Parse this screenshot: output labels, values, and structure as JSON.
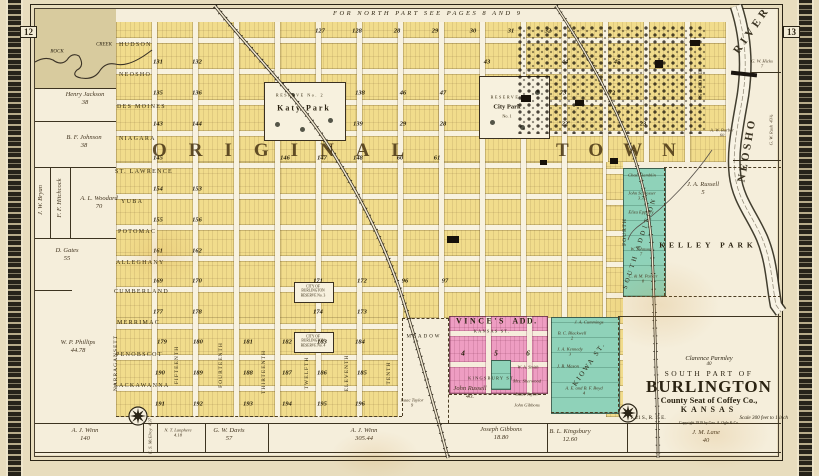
{
  "page": {
    "left_num": "12",
    "right_num": "13",
    "top_note": "FOR NORTH PART SEE PAGES 8 AND 9"
  },
  "title_block": {
    "owner": "Clarence Parmley",
    "owner_acres": "40",
    "part": "SOUTH PART OF",
    "city": "BURLINGTON",
    "seat": "County Seat of Coffey Co.,",
    "state": "KANSAS",
    "township": "T. 21 S., R. 15 E.",
    "scale": "Scale 300 feet to 1 inch",
    "copyright": "Copyright 1919 by Geo. A. Ogle & Co."
  },
  "big_labels": {
    "original": "ORIGINAL",
    "town": "TOWN"
  },
  "river": {
    "top": "RIVER",
    "side": "NEOSHO"
  },
  "creek": {
    "w1": "ROCK",
    "w2": "CREEK"
  },
  "parks": {
    "katy": {
      "reserve": "RESERVE",
      "no": "No. 2",
      "name": "Katy Park"
    },
    "city": {
      "reserve": "RESERVE",
      "name": "City Park",
      "no": "No. 1"
    },
    "kelley": "KELLEY PARK"
  },
  "reserves": [
    {
      "l1": "CITY OF",
      "l2": "BURLINGTON",
      "l3": "RESERVE No. 3",
      "x": 294,
      "y": 282
    },
    {
      "l1": "CITY OF",
      "l2": "BURLINGTON",
      "l3": "RESERVE No. 4",
      "x": 294,
      "y": 332
    }
  ],
  "additions": {
    "vince1": "VINCE'S",
    "vince2": "ADD.",
    "kansas": "KANSAS ST.",
    "kingsbury": "KINGSBURY ST.",
    "vince_blocks": [
      {
        "n": "4",
        "x": 463,
        "y": 353
      },
      {
        "n": "5",
        "x": 496,
        "y": 353
      },
      {
        "n": "6",
        "x": 528,
        "y": 353
      }
    ],
    "south": "SOUTH ADDITION",
    "kiowa": "KIOWA ST.",
    "meadow": "MEADOW"
  },
  "streets_ew": [
    {
      "name": "HUDSON",
      "x": 119,
      "y": 45
    },
    {
      "name": "NEOSHO",
      "x": 119,
      "y": 75
    },
    {
      "name": "DES MOINES",
      "x": 117,
      "y": 107
    },
    {
      "name": "NIAGARA",
      "x": 119,
      "y": 139
    },
    {
      "name": "ST. LAWRENCE",
      "x": 115,
      "y": 172
    },
    {
      "name": "YUBA",
      "x": 121,
      "y": 202
    },
    {
      "name": "POTOMAC",
      "x": 118,
      "y": 232
    },
    {
      "name": "ALLEGHANY",
      "x": 116,
      "y": 263
    },
    {
      "name": "CUMBERLAND",
      "x": 114,
      "y": 292
    },
    {
      "name": "MERRIMAC",
      "x": 117,
      "y": 323
    },
    {
      "name": "PENOBSCOT",
      "x": 116,
      "y": 355
    },
    {
      "name": "LACKAWANNA",
      "x": 114,
      "y": 386
    }
  ],
  "streets_ns": [
    {
      "name": "NARRAGANSETT",
      "x": 116,
      "y": 363
    },
    {
      "name": "FIFTEENTH",
      "x": 177,
      "y": 365
    },
    {
      "name": "FOURTEENTH",
      "x": 221,
      "y": 365
    },
    {
      "name": "THIRTEENTH",
      "x": 264,
      "y": 372
    },
    {
      "name": "TWELFTH",
      "x": 307,
      "y": 373
    },
    {
      "name": "ELEVENTH",
      "x": 347,
      "y": 373
    },
    {
      "name": "TENTH",
      "x": 389,
      "y": 373
    },
    {
      "name": "FOURTH",
      "x": 625,
      "y": 232
    },
    {
      "name": "SECOND",
      "x": 701,
      "y": 83
    }
  ],
  "parcels": [
    {
      "name": "Henry Jackson",
      "acres": "38",
      "x": 85,
      "y": 99
    },
    {
      "name": "B. F. Johnson",
      "acres": "38",
      "x": 84,
      "y": 142
    },
    {
      "name": "J. W. Bryan",
      "acres": "",
      "x": 41,
      "y": 200,
      "rot": -90
    },
    {
      "name": "F. F. Hitchcock",
      "acres": "",
      "x": 60,
      "y": 198,
      "rot": -90
    },
    {
      "name": "A. L. Woodard",
      "acres": "70",
      "x": 99,
      "y": 203
    },
    {
      "name": "D. Gates",
      "acres": "55",
      "x": 67,
      "y": 255
    },
    {
      "name": "W. P. Phillips",
      "acres": "44.78",
      "x": 78,
      "y": 347
    },
    {
      "name": "A. J. Winn",
      "acres": "140",
      "x": 85,
      "y": 435
    },
    {
      "name": "E. S. McElroy",
      "acres": "4.37",
      "x": 150,
      "y": 436,
      "rot": -90,
      "sm": 1
    },
    {
      "name": "N. T. Lanphere",
      "acres": "4.18",
      "x": 178,
      "y": 433,
      "sm": 1
    },
    {
      "name": "G. W. Davis",
      "acres": "57",
      "x": 229,
      "y": 435
    },
    {
      "name": "A. J. Winn",
      "acres": "305.44",
      "x": 364,
      "y": 435
    },
    {
      "name": "Isaac Taylor",
      "acres": "9",
      "x": 412,
      "y": 403,
      "sm": 1
    },
    {
      "name": "John Russell",
      "acres": "40.",
      "x": 470,
      "y": 393
    },
    {
      "name": "W. A. Smith",
      "acres": "",
      "x": 528,
      "y": 367,
      "sm": 1
    },
    {
      "name": "Mrs. Sherwood",
      "acres": "",
      "x": 527,
      "y": 381,
      "sm": 1
    },
    {
      "name": "Isaac Taylor",
      "acres": "",
      "x": 527,
      "y": 394,
      "sm": 1
    },
    {
      "name": "John Gibbons",
      "acres": "",
      "x": 527,
      "y": 405,
      "sm": 1
    },
    {
      "name": "Joseph Gibbons",
      "acres": "18.80",
      "x": 501,
      "y": 434
    },
    {
      "name": "B. L. Kingsbury",
      "acres": "12.60",
      "x": 570,
      "y": 436
    },
    {
      "name": "J. M. Lane",
      "acres": "40",
      "x": 706,
      "y": 437
    },
    {
      "name": "J. A. Cummings",
      "acres": "",
      "x": 589,
      "y": 322,
      "sm": 1
    },
    {
      "name": "B. C. Blackwell",
      "acres": "2",
      "x": 572,
      "y": 336,
      "sm": 1
    },
    {
      "name": "J. A. Kennedy",
      "acres": "3",
      "x": 570,
      "y": 352,
      "sm": 1
    },
    {
      "name": "J. B. Mason",
      "acres": "",
      "x": 568,
      "y": 366,
      "sm": 1
    },
    {
      "name": "A. E. and B. F. Boyd",
      "acres": "4",
      "x": 584,
      "y": 391,
      "sm": 1
    },
    {
      "name": "J. A. Russell",
      "acres": "5",
      "x": 703,
      "y": 189
    },
    {
      "name": "G. W. Hicks",
      "acres": "7",
      "x": 762,
      "y": 64,
      "sm": 1
    },
    {
      "name": "G. W. Rush",
      "acres": "43¾",
      "x": 771,
      "y": 130,
      "rot": -90,
      "sm": 1
    },
    {
      "name": "A. W. Barber",
      "acres": "60",
      "x": 722,
      "y": 133,
      "sm": 1
    },
    {
      "name": "Chas. Hamblin",
      "acres": "1",
      "x": 642,
      "y": 178,
      "sm": 1
    },
    {
      "name": "John Schlosser",
      "acres": "3.32",
      "x": 642,
      "y": 196,
      "sm": 1
    },
    {
      "name": "Eliza Epperly",
      "acres": "",
      "x": 641,
      "y": 212,
      "sm": 1
    },
    {
      "name": "W. Johnson",
      "acres": "7",
      "x": 641,
      "y": 252,
      "sm": 1
    },
    {
      "name": "C. & M. Parker",
      "acres": "8",
      "x": 643,
      "y": 279,
      "sm": 1
    }
  ],
  "block_numbers": [
    {
      "n": "127",
      "x": 320,
      "y": 31
    },
    {
      "n": "128",
      "x": 357,
      "y": 31
    },
    {
      "n": "28",
      "x": 397,
      "y": 31
    },
    {
      "n": "29",
      "x": 435,
      "y": 31
    },
    {
      "n": "30",
      "x": 473,
      "y": 31
    },
    {
      "n": "31",
      "x": 511,
      "y": 31
    },
    {
      "n": "32",
      "x": 548,
      "y": 31
    },
    {
      "n": "131",
      "x": 158,
      "y": 62
    },
    {
      "n": "132",
      "x": 197,
      "y": 62
    },
    {
      "n": "43",
      "x": 487,
      "y": 62
    },
    {
      "n": "44",
      "x": 565,
      "y": 62
    },
    {
      "n": "45",
      "x": 617,
      "y": 62
    },
    {
      "n": "135",
      "x": 158,
      "y": 93
    },
    {
      "n": "136",
      "x": 197,
      "y": 93
    },
    {
      "n": "138",
      "x": 360,
      "y": 93
    },
    {
      "n": "46",
      "x": 403,
      "y": 93
    },
    {
      "n": "47",
      "x": 443,
      "y": 93
    },
    {
      "n": "73",
      "x": 563,
      "y": 93
    },
    {
      "n": "72",
      "x": 612,
      "y": 93
    },
    {
      "n": "143",
      "x": 158,
      "y": 124
    },
    {
      "n": "144",
      "x": 197,
      "y": 124
    },
    {
      "n": "139",
      "x": 358,
      "y": 124
    },
    {
      "n": "29",
      "x": 403,
      "y": 124
    },
    {
      "n": "28",
      "x": 443,
      "y": 124
    },
    {
      "n": "22",
      "x": 565,
      "y": 124
    },
    {
      "n": "23",
      "x": 643,
      "y": 124
    },
    {
      "n": "145",
      "x": 158,
      "y": 158
    },
    {
      "n": "146",
      "x": 285,
      "y": 158
    },
    {
      "n": "147",
      "x": 322,
      "y": 158
    },
    {
      "n": "148",
      "x": 358,
      "y": 158
    },
    {
      "n": "60",
      "x": 400,
      "y": 158
    },
    {
      "n": "61",
      "x": 437,
      "y": 158
    },
    {
      "n": "154",
      "x": 158,
      "y": 189
    },
    {
      "n": "153",
      "x": 197,
      "y": 189
    },
    {
      "n": "155",
      "x": 158,
      "y": 220
    },
    {
      "n": "156",
      "x": 197,
      "y": 220
    },
    {
      "n": "161",
      "x": 158,
      "y": 251
    },
    {
      "n": "162",
      "x": 197,
      "y": 251
    },
    {
      "n": "169",
      "x": 158,
      "y": 281
    },
    {
      "n": "170",
      "x": 197,
      "y": 281
    },
    {
      "n": "171",
      "x": 318,
      "y": 281
    },
    {
      "n": "172",
      "x": 362,
      "y": 281
    },
    {
      "n": "96",
      "x": 405,
      "y": 281
    },
    {
      "n": "97",
      "x": 445,
      "y": 281
    },
    {
      "n": "177",
      "x": 158,
      "y": 312
    },
    {
      "n": "178",
      "x": 197,
      "y": 312
    },
    {
      "n": "174",
      "x": 318,
      "y": 312
    },
    {
      "n": "173",
      "x": 362,
      "y": 312
    },
    {
      "n": "179",
      "x": 162,
      "y": 342
    },
    {
      "n": "180",
      "x": 198,
      "y": 342
    },
    {
      "n": "181",
      "x": 248,
      "y": 342
    },
    {
      "n": "182",
      "x": 287,
      "y": 342
    },
    {
      "n": "183",
      "x": 322,
      "y": 342
    },
    {
      "n": "184",
      "x": 360,
      "y": 342
    },
    {
      "n": "190",
      "x": 160,
      "y": 373
    },
    {
      "n": "189",
      "x": 198,
      "y": 373
    },
    {
      "n": "188",
      "x": 248,
      "y": 373
    },
    {
      "n": "187",
      "x": 287,
      "y": 373
    },
    {
      "n": "186",
      "x": 322,
      "y": 373
    },
    {
      "n": "185",
      "x": 362,
      "y": 373
    },
    {
      "n": "191",
      "x": 160,
      "y": 404
    },
    {
      "n": "192",
      "x": 198,
      "y": 404
    },
    {
      "n": "193",
      "x": 248,
      "y": 404
    },
    {
      "n": "194",
      "x": 287,
      "y": 404
    },
    {
      "n": "195",
      "x": 322,
      "y": 404
    },
    {
      "n": "196",
      "x": 360,
      "y": 404
    }
  ],
  "lines": [
    {
      "x": 35,
      "y": 88,
      "len": 81
    },
    {
      "x": 35,
      "y": 121,
      "len": 81
    },
    {
      "x": 35,
      "y": 167,
      "len": 81
    },
    {
      "x": 35,
      "y": 238,
      "len": 81
    },
    {
      "x": 35,
      "y": 290,
      "len": 37
    },
    {
      "x": 750,
      "y": 72,
      "len": 31
    },
    {
      "x": 733,
      "y": 160,
      "len": 48
    },
    {
      "x": 35,
      "y": 423,
      "len": 746
    },
    {
      "x": 35,
      "y": 452,
      "len": 746
    },
    {
      "x": 618,
      "y": 316,
      "len": 163
    },
    {
      "x": 50,
      "y": 167,
      "len": 71,
      "v": 1
    },
    {
      "x": 70,
      "y": 167,
      "len": 71,
      "v": 1
    },
    {
      "x": 143,
      "y": 423,
      "len": 29,
      "v": 1
    },
    {
      "x": 157,
      "y": 423,
      "len": 29,
      "v": 1
    },
    {
      "x": 205,
      "y": 423,
      "len": 29,
      "v": 1
    },
    {
      "x": 268,
      "y": 423,
      "len": 29,
      "v": 1
    },
    {
      "x": 547,
      "y": 423,
      "len": 29,
      "v": 1
    },
    {
      "x": 627,
      "y": 423,
      "len": 29,
      "v": 1
    },
    {
      "x": 116,
      "y": 416,
      "len": 286,
      "dash": 1
    },
    {
      "x": 402,
      "y": 318,
      "len": 98,
      "v": 1,
      "dash": 1
    },
    {
      "x": 402,
      "y": 318,
      "len": 47,
      "dash": 1
    },
    {
      "x": 448,
      "y": 318,
      "len": 105,
      "v": 1,
      "dash": 1
    },
    {
      "x": 664,
      "y": 168,
      "len": 128,
      "v": 1,
      "dash": 1
    },
    {
      "x": 623,
      "y": 296,
      "len": 41,
      "dash": 1
    },
    {
      "x": 664,
      "y": 167,
      "len": 117,
      "dash": 1
    },
    {
      "x": 664,
      "y": 296,
      "len": 117,
      "dash": 1
    },
    {
      "x": 618,
      "y": 317,
      "len": 95,
      "v": 1,
      "dash": 1
    },
    {
      "x": 551,
      "y": 412,
      "len": 76,
      "dash": 1
    },
    {
      "x": 449,
      "y": 394,
      "len": 97,
      "dash": 1
    }
  ]
}
